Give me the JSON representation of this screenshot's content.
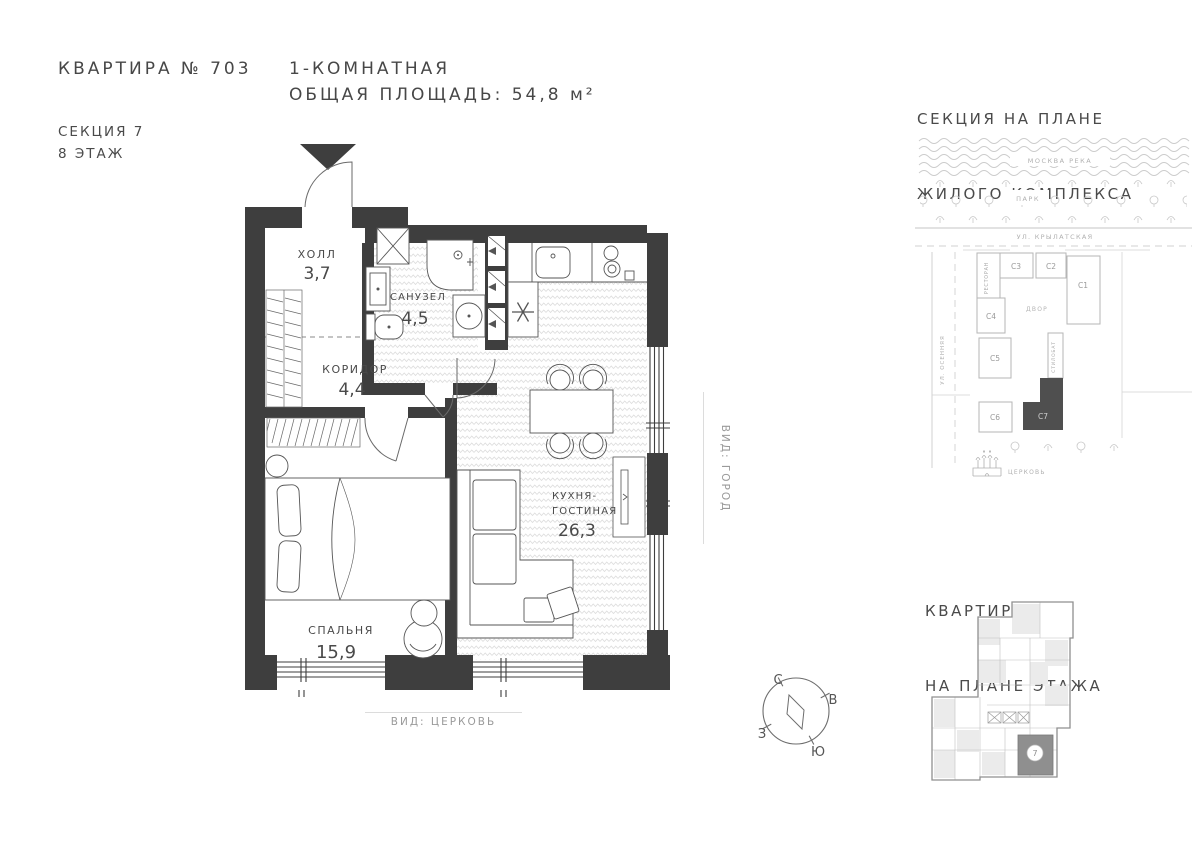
{
  "header": {
    "apartment_title": "КВАРТИРА № 703",
    "type_line": "1-КОМНАТНАЯ",
    "area_line": "ОБЩАЯ ПЛОЩАДЬ: 54,8 м²",
    "section_line1": "СЕКЦИЯ 7",
    "section_line2": "8 ЭТАЖ"
  },
  "floor_plan": {
    "rooms": {
      "hall": {
        "name": "ХОЛЛ",
        "area": "3,7"
      },
      "bathroom": {
        "name": "САНУЗЕЛ",
        "area": "4,5"
      },
      "corridor": {
        "name": "КОРИДОР",
        "area": "4,4"
      },
      "kitchen_living": {
        "name_line1": "КУХНЯ-",
        "name_line2": "ГОСТИНАЯ",
        "area": "26,3"
      },
      "bedroom": {
        "name": "СПАЛЬНЯ",
        "area": "15,9"
      }
    },
    "view_right": "ВИД: ГОРОД",
    "view_bottom": "ВИД: ЦЕРКОВЬ"
  },
  "compass": {
    "north": "С",
    "east": "В",
    "south": "Ю",
    "west": "З"
  },
  "complex_map": {
    "title_line1": "СЕКЦИЯ НА ПЛАНЕ",
    "title_line2": "ЖИЛОГО КОМПЛЕКСА",
    "river": "МОСКВА РЕКА",
    "park": "ПАРК",
    "street_top": "УЛ. КРЫЛАТСКАЯ",
    "street_left": "УЛ. ОСЕННЯЯ",
    "restaurant": "РЕСТОРАН",
    "courtyard": "ДВОР",
    "stylobate": "СТИЛОБАТ",
    "church": "ЦЕРКОВЬ",
    "buildings": {
      "c1": "С1",
      "c2": "С2",
      "c3": "С3",
      "c4": "С4",
      "c5": "С5",
      "c6": "С6",
      "c7": "С7"
    },
    "highlighted_building": "С7"
  },
  "floor_map": {
    "title_line1": "КВАРТИРА",
    "title_line2": "НА ПЛАНЕ ЭТАЖА",
    "marker": "7"
  },
  "colors": {
    "wall": "#3e3e3e",
    "line": "#555555",
    "map_gray": "#c4c4c4",
    "muted_text": "#9a9a9a",
    "highlight": "#8f8f8f"
  }
}
